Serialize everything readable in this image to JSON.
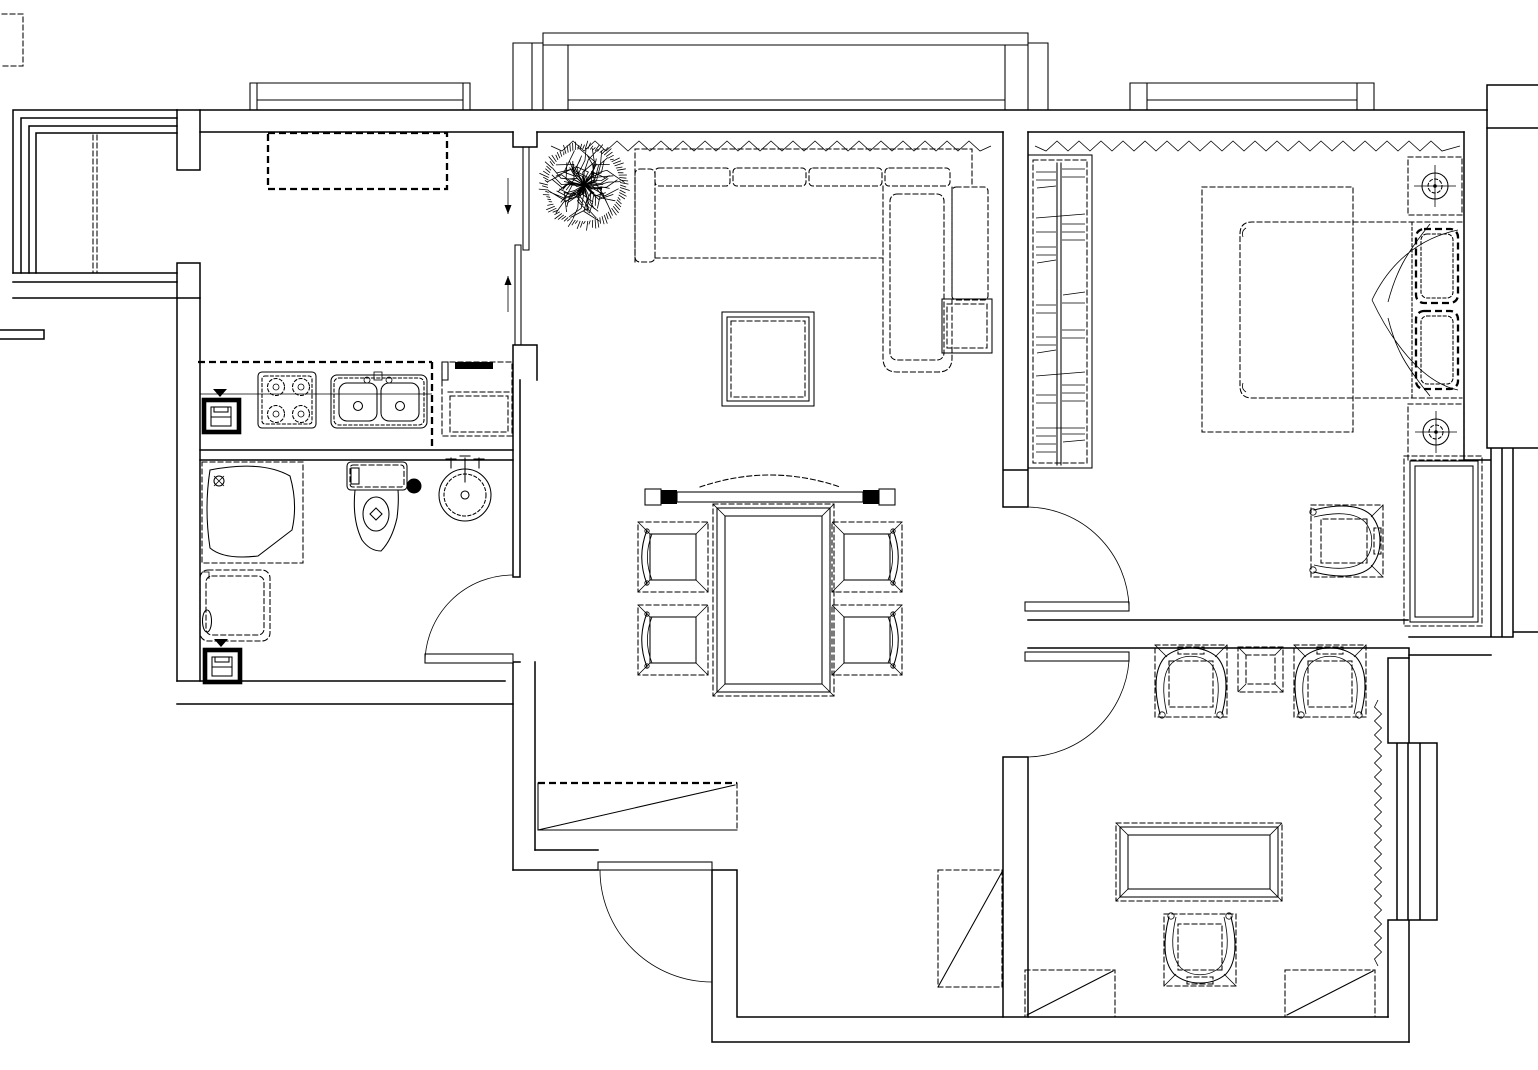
{
  "canvas": {
    "width": 1538,
    "height": 1070,
    "background_color": "#ffffff",
    "line_color": "#000000"
  },
  "title": {
    "label": "apartment floor plan (CAD line drawing)"
  },
  "floorplan": {
    "style": "black-and-white architectural plan, no text labels",
    "rooms": [
      {
        "name": "balcony",
        "position": "top-left",
        "items": [
          "corner-glazing",
          "folding-partition"
        ]
      },
      {
        "name": "kitchen",
        "position": "left-upper",
        "items": [
          "window",
          "overhead-cabinet",
          "floor-drain",
          "gas-stove-4-burner",
          "double-bowl-sink",
          "tall-cabinet",
          "counter",
          "sliding-door"
        ]
      },
      {
        "name": "bathroom",
        "position": "left-lower",
        "items": [
          "corner-shower",
          "toilet",
          "round-washbasin",
          "washing-machine",
          "floor-drain",
          "swing-door"
        ]
      },
      {
        "name": "living-room",
        "position": "center-top",
        "items": [
          "bay-window",
          "curtain-zigzag",
          "potted-plant",
          "sectional-sofa",
          "sofa-side-table",
          "square-coffee-table"
        ]
      },
      {
        "name": "dining-area",
        "position": "center",
        "items": [
          "console-bar",
          "pendant-arc",
          "dining-table",
          "dining-chair-x4"
        ]
      },
      {
        "name": "entry-hallway",
        "position": "bottom-center",
        "items": [
          "entry-door",
          "shoe-cabinet",
          "hall-cabinet"
        ]
      },
      {
        "name": "bedroom",
        "position": "right-top",
        "items": [
          "window",
          "curtain-zigzag",
          "wardrobe",
          "double-bed",
          "pillow-x2",
          "nightstand-x2",
          "bedside-lamp-x2",
          "carpet",
          "armchair",
          "dresser",
          "swing-door"
        ]
      },
      {
        "name": "study-lounge",
        "position": "bottom-right",
        "items": [
          "armchair-x3",
          "side-table",
          "tea-table",
          "corner-cabinet-x2",
          "bay-window",
          "curtain-zigzag",
          "swing-door"
        ]
      }
    ],
    "doors": [
      "kitchen-sliding-door",
      "bathroom-door",
      "entry-door",
      "bedroom-door",
      "study-door"
    ],
    "windows": [
      "balcony-glazing",
      "kitchen-window",
      "living-bay-window",
      "bedroom-window",
      "study-bay-window"
    ]
  }
}
